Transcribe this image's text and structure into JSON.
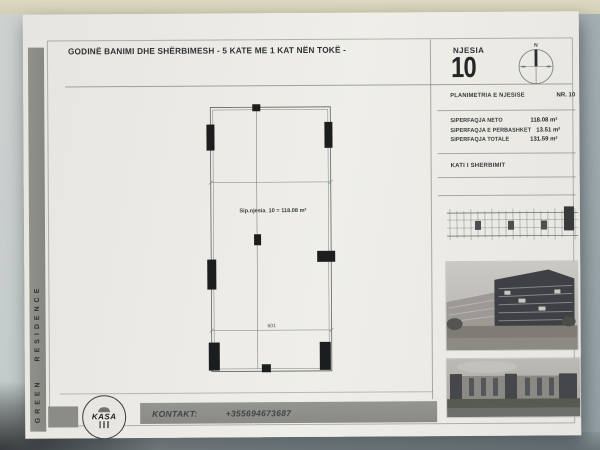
{
  "colors": {
    "paper": "#ebe9e4",
    "background": "#aeb9bd",
    "top_strip": "#d9d6bc",
    "bar_gray": "#8b8c88",
    "ink": "#2f3336",
    "line_gray": "#7a8084",
    "plan_line": "#5d6366",
    "column_black": "#1c1d1e"
  },
  "header": {
    "title": "GODINË BANIMI DHE SHËRBIMESH - 5 KATE ME 1 KAT NËN TOKË -",
    "unit_label": "NJESIA",
    "unit_number": "10",
    "compass_north": "N"
  },
  "sidebar": {
    "brand": "GREEN RESIDENCE"
  },
  "info_panel": {
    "plan_title": "PLANIMETRIA E NJESISE",
    "plan_number": "NR. 10",
    "areas": [
      {
        "label": "SIPERFAQJA NETO",
        "value": "118.08 m²"
      },
      {
        "label": "SIPERFAQJA E PERBASHKET",
        "value": "13.51 m²"
      },
      {
        "label": "SIPERFAQJA TOTALE",
        "value": "131.59 m²"
      }
    ],
    "floor_label": "KATI I SHERBIMIT"
  },
  "floor_plan": {
    "area_label": "Sip.njesia_10 = 118.08 m²",
    "dimension_label": "601"
  },
  "footer": {
    "logo_text": "KASA",
    "contact_label": "KONTAKT:",
    "contact_phone": "+355694673687"
  }
}
